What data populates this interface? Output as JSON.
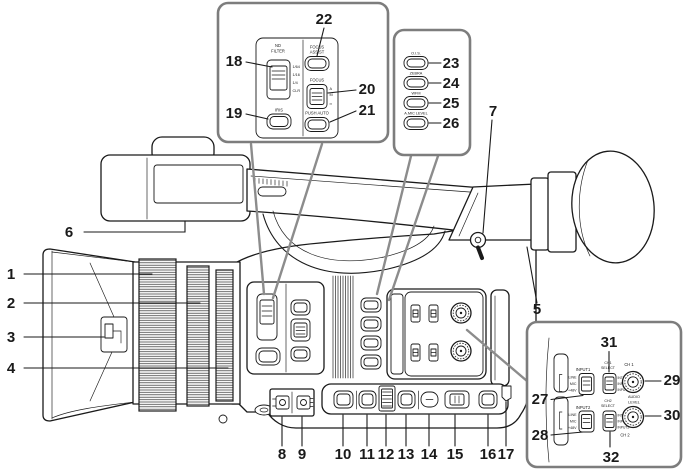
{
  "diagram": {
    "title": "camcorder-side-view-parts-diagram",
    "colors": {
      "bg": "#ffffff",
      "line": "#1a1a1a",
      "box-border": "#7d7d7d",
      "funnel": "#8c8c8c"
    }
  },
  "callouts": [
    "1",
    "2",
    "3",
    "4",
    "5",
    "6",
    "7",
    "8",
    "9",
    "10",
    "11",
    "12",
    "13",
    "14",
    "15",
    "16",
    "17",
    "18",
    "19",
    "20",
    "21",
    "22",
    "23",
    "24",
    "25",
    "26",
    "27",
    "28",
    "29",
    "30",
    "31",
    "32"
  ],
  "inset_nd_panel": {
    "nd_label_line1": "ND",
    "nd_label_line2": "FILTER",
    "nd_positions": [
      "1/64",
      "1/16",
      "1/4",
      "CLR"
    ],
    "iris_label": "IRIS",
    "focus_assist_line1": "FOCUS",
    "focus_assist_line2": "ASSIST",
    "focus_label": "FOCUS",
    "focus_positions": [
      "A",
      "M",
      "∞"
    ],
    "push_auto_label": "PUSH AUTO"
  },
  "inset_function_buttons": {
    "ois_label": "O.I.S.",
    "zebra_label": "ZEBRA",
    "wfm_label": "WFM",
    "a_mic_level_label": "A.MIC LEVEL"
  },
  "inset_audio_panel": {
    "input1_label": "INPUT1",
    "input2_label": "INPUT2",
    "input_positions": [
      "LINE",
      "MIC",
      "+48V"
    ],
    "ch1_select_line1": "CH1",
    "ch1_select_line2": "SELECT",
    "ch2_select_line1": "CH2",
    "ch2_select_line2": "SELECT",
    "ch1_select_positions": [
      "INT(L)",
      "INPUT1",
      "INPUT2"
    ],
    "ch2_select_positions": [
      "INT(R)",
      "INPUT1",
      "INPUT2"
    ],
    "audio_level_line1": "AUDIO",
    "audio_level_line2": "LEVEL",
    "ch1_label": "CH 1",
    "ch2_label": "CH 2"
  }
}
